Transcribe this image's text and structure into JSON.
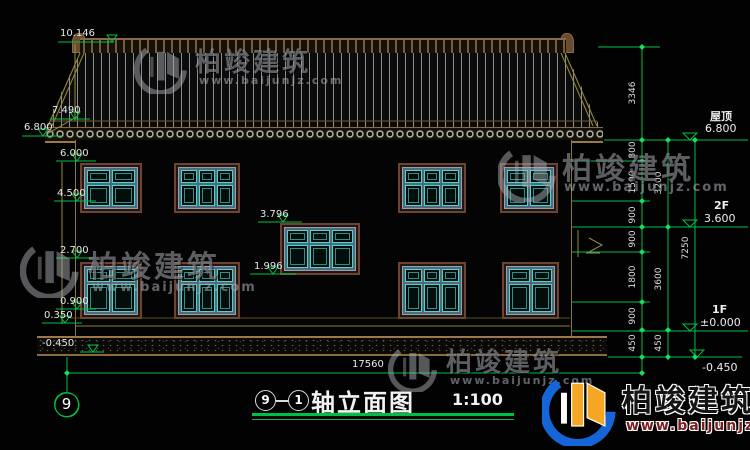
{
  "drawing": {
    "levels": {
      "ridge": "10.146",
      "eave": "7.490",
      "eave_tip": "6.800",
      "w2_head": "6.000",
      "w2_sill": "4.500",
      "stair_head": "3.796",
      "stair_sill": "1.996",
      "w1_head": "2.700",
      "w1_sill": "0.900",
      "plinth": "0.350",
      "ground": "-0.450"
    },
    "floors": {
      "roof_label": "屋顶",
      "roof_level": "6.800",
      "f2_label": "2F",
      "f2_level": "3.600",
      "f1_label": "1F",
      "f1_level": "±0.000",
      "ground_level": "-0.450"
    },
    "dims": {
      "total_width": "17560",
      "total_height": "7250",
      "roof_rise": "3346",
      "chain_a": [
        "800",
        "1500",
        "900",
        "900",
        "1800",
        "900",
        "450"
      ],
      "chain_b": [
        "3200",
        "3600",
        "450"
      ]
    },
    "axes": {
      "bubble_left": "9",
      "title_start": "9",
      "title_end": "1"
    },
    "title": {
      "name": "轴立面图",
      "scale": "1:100"
    }
  },
  "watermark": {
    "brand": "柏竣建筑",
    "site": "www.baijunjz.com"
  },
  "colors": {
    "dim_green": "#00bf45",
    "tan": "#9a8a3c",
    "teal": "#45d8cc",
    "frame_brown": "#6b4434",
    "logo_blue": "#1565d8",
    "logo_orange": "#f5a623"
  }
}
